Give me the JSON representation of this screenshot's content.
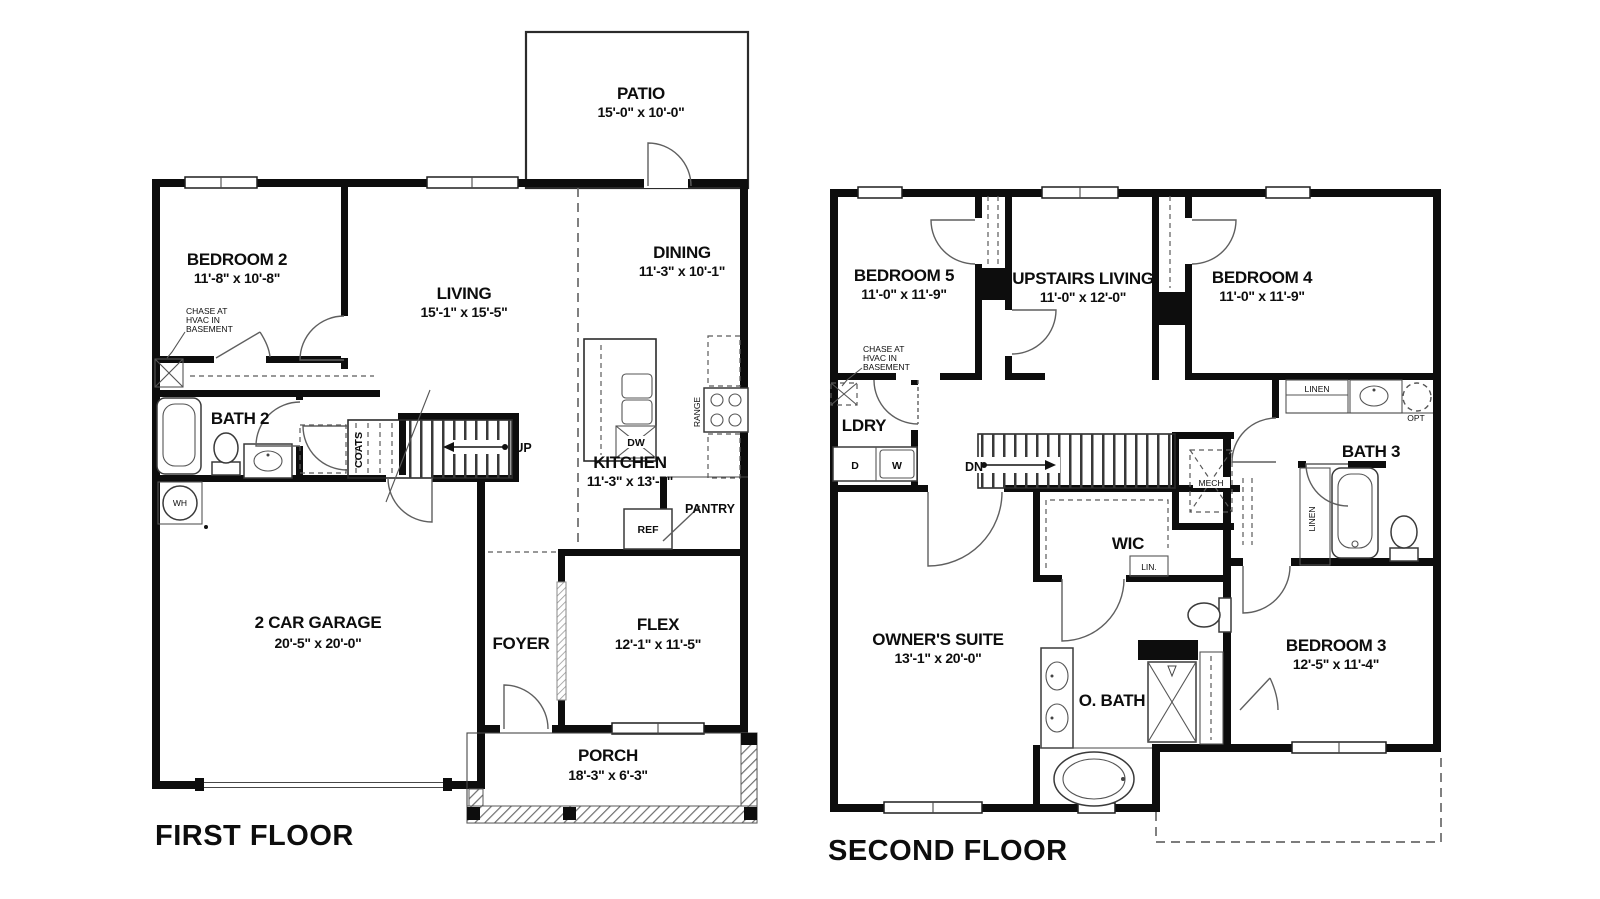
{
  "first_floor": {
    "title": "FIRST FLOOR",
    "rooms": {
      "patio": {
        "name": "PATIO",
        "dims": "15'-0\" x 10'-0\""
      },
      "bedroom2": {
        "name": "BEDROOM 2",
        "dims": "11'-8\" x 10'-8\""
      },
      "living": {
        "name": "LIVING",
        "dims": "15'-1\" x 15'-5\""
      },
      "dining": {
        "name": "DINING",
        "dims": "11'-3\" x 10'-1\""
      },
      "bath2": {
        "name": "BATH 2"
      },
      "kitchen": {
        "name": "KITCHEN",
        "dims": "11'-3\" x 13'-7\""
      },
      "garage": {
        "name": "2 CAR GARAGE",
        "dims": "20'-5\" x 20'-0\""
      },
      "foyer": {
        "name": "FOYER"
      },
      "flex": {
        "name": "FLEX",
        "dims": "12'-1\" x 11'-5\""
      },
      "porch": {
        "name": "PORCH",
        "dims": "18'-3\" x 6'-3\""
      },
      "pantry": {
        "name": "PANTRY"
      }
    },
    "labels": {
      "up": "UP",
      "coats": "COATS",
      "wh": "WH",
      "ref": "REF",
      "dw": "DW",
      "range": "RANGE"
    },
    "chase_note": [
      "CHASE AT",
      "HVAC IN",
      "BASEMENT"
    ]
  },
  "second_floor": {
    "title": "SECOND FLOOR",
    "rooms": {
      "bedroom5": {
        "name": "BEDROOM 5",
        "dims": "11'-0\" x 11'-9\""
      },
      "upstairs_living": {
        "name": "UPSTAIRS LIVING",
        "dims": "11'-0\" x 12'-0\""
      },
      "bedroom4": {
        "name": "BEDROOM 4",
        "dims": "11'-0\" x 11'-9\""
      },
      "ldry": {
        "name": "LDRY"
      },
      "bath3": {
        "name": "BATH 3"
      },
      "wic": {
        "name": "WIC"
      },
      "owners_suite": {
        "name": "OWNER'S SUITE",
        "dims": "13'-1\" x 20'-0\""
      },
      "obath": {
        "name": "O. BATH"
      },
      "bedroom3": {
        "name": "BEDROOM 3",
        "dims": "12'-5\" x 11'-4\""
      }
    },
    "labels": {
      "dn": "DN",
      "mech": "MECH",
      "lin": "LIN.",
      "linen_top": "LINEN",
      "linen_side": "LINEN",
      "opt": "OPT",
      "d": "D",
      "w": "W"
    },
    "chase_note": [
      "CHASE AT",
      "HVAC IN",
      "BASEMENT"
    ]
  },
  "colors": {
    "wall": "#0d0d0d",
    "background": "#ffffff",
    "thin_line": "#2b2b2b",
    "dashed_line": "#5a5a5a"
  }
}
